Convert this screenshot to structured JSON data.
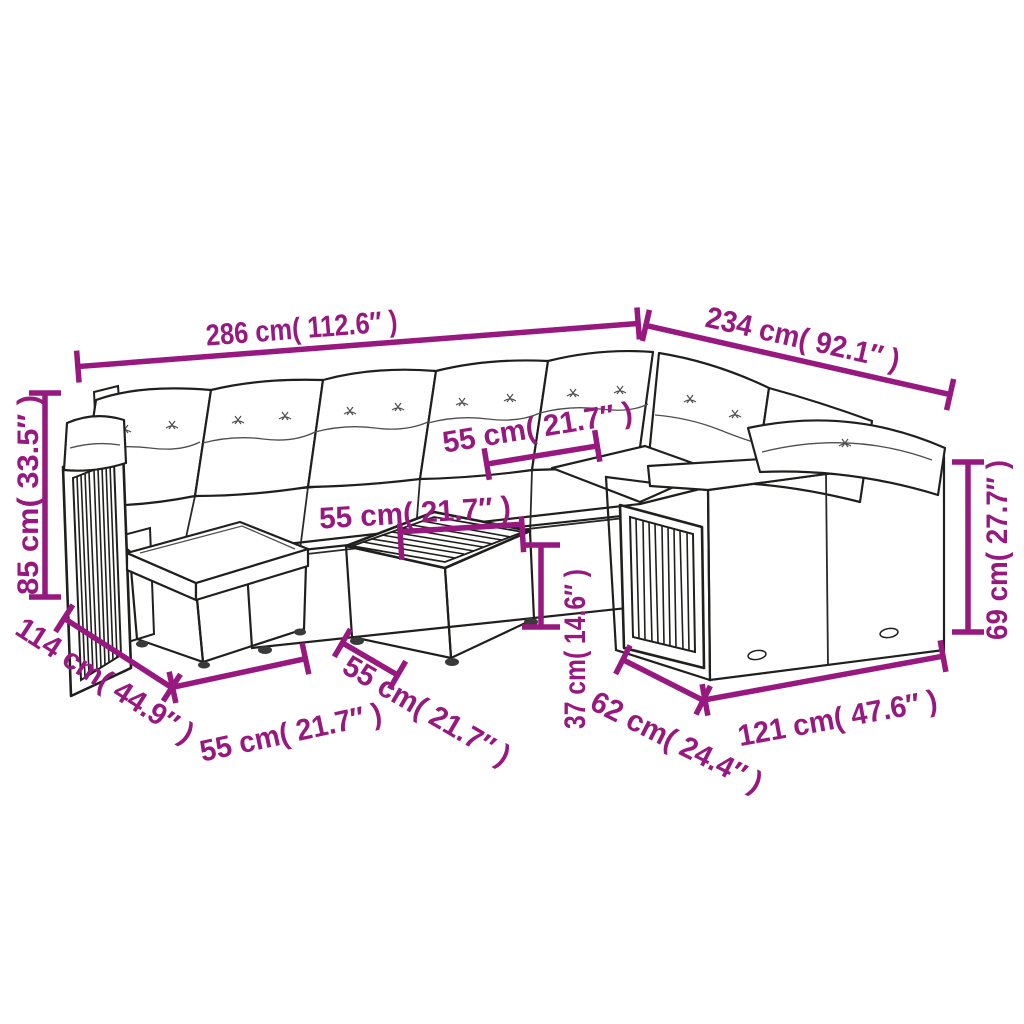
{
  "figure": {
    "type": "product-dimension-diagram",
    "subject": "rattan garden lounge set with sofa sections, ottoman and coffee table"
  },
  "colors": {
    "background": "#FFFFFF",
    "dimension_annotation": "#97187E",
    "line_art_outline": "#1F1F1D",
    "wicker_gray": "#96999B",
    "wicker_dark_gray": "#7E8183"
  },
  "dimensions": [
    {
      "name": "back-width-left",
      "label": "286 cm( 112.6″ )",
      "cm": 286,
      "inches": 112.6
    },
    {
      "name": "back-width-right",
      "label": "234 cm( 92.1″ )",
      "cm": 234,
      "inches": 92.1
    },
    {
      "name": "total-height",
      "label": "85 cm( 33.5″ )",
      "cm": 85,
      "inches": 33.5
    },
    {
      "name": "seat-width",
      "label": "55 cm( 21.7″ )",
      "cm": 55,
      "inches": 21.7
    },
    {
      "name": "table-top-width",
      "label": "55 cm( 21.7″ )",
      "cm": 55,
      "inches": 21.7
    },
    {
      "name": "table-height",
      "label": "37 cm( 14.6″ )",
      "cm": 37,
      "inches": 14.6
    },
    {
      "name": "left-section-depth",
      "label": "114 cm( 44.9″ )",
      "cm": 114,
      "inches": 44.9
    },
    {
      "name": "ottoman-width",
      "label": "55 cm( 21.7″ )",
      "cm": 55,
      "inches": 21.7
    },
    {
      "name": "table-top-depth",
      "label": "55 cm( 21.7″ )",
      "cm": 55,
      "inches": 21.7
    },
    {
      "name": "side-section-depth",
      "label": "62 cm( 24.4″ )",
      "cm": 62,
      "inches": 24.4
    },
    {
      "name": "right-section-width",
      "label": "121 cm( 47.6″ )",
      "cm": 121,
      "inches": 47.6
    },
    {
      "name": "arm-height",
      "label": "69 cm( 27.7″ )",
      "cm": 69,
      "inches": 27.7
    }
  ]
}
